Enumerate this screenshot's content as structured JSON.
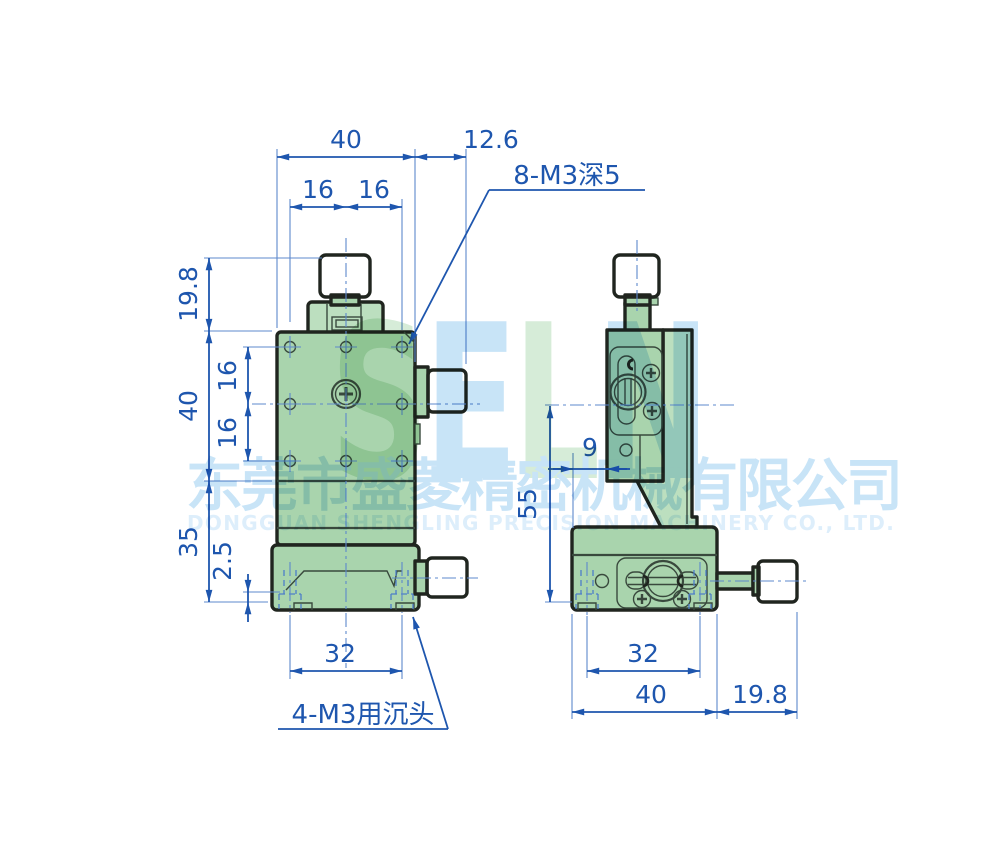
{
  "drawing": {
    "front": {
      "top_width": "40",
      "top_offset": "12.6",
      "top_pitch_left": "16",
      "top_pitch_right": "16",
      "thread_note_top": "8-M3深5",
      "knob_height": "19.8",
      "body_height": "40",
      "pitch_upper": "16",
      "pitch_lower": "16",
      "base_height": "35",
      "lip_height": "2.5",
      "bottom_pitch": "32",
      "thread_note_bottom": "4-M3用沉头"
    },
    "side": {
      "height": "55",
      "offset": "9",
      "bottom_pitch": "32",
      "base_width": "40",
      "knob_length": "19.8"
    }
  },
  "watermark": {
    "letters": [
      {
        "ch": "S"
      },
      {
        "ch": "E"
      },
      {
        "ch": "L"
      },
      {
        "ch": "N"
      }
    ],
    "company_cn": "东莞市盛菱精密机械有限公司",
    "company_en": "DONGGUAN SHENGLING PRECISION MACHINERY CO., LTD."
  },
  "colors": {
    "dimblue": "#1e56ae",
    "extblue": "#5d88cc",
    "hidden": "#4d7dc9",
    "outline": "#20251f",
    "inner": "#39493d",
    "green1": "#a9d4ad",
    "green2": "#bcdfbf",
    "knurl": "#2e4434",
    "wmblue": "#c8e4f7",
    "wmblue2": "#ddeefb",
    "wmgreen": "#d6ecd8"
  }
}
